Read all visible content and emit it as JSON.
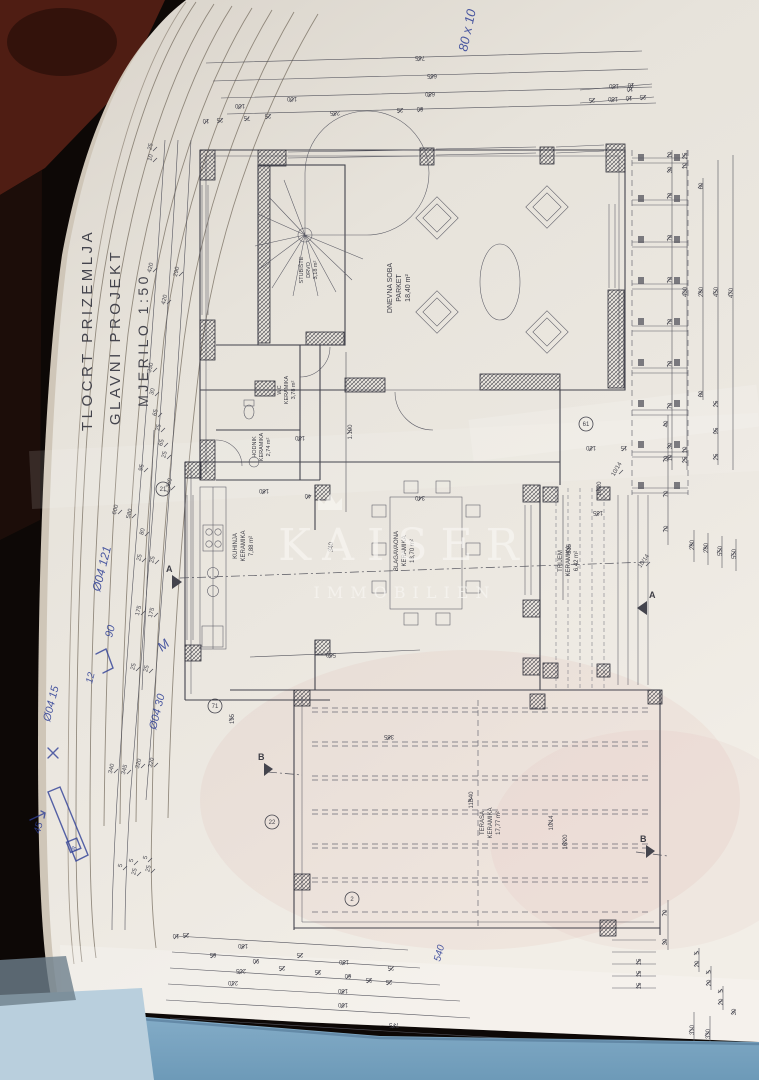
{
  "title_block": {
    "line1": "TLOCRT PRIZEMLJA",
    "line2": "GLAVNI PROJEKT",
    "line3": "MJERILO 1:50"
  },
  "watermark": {
    "name": "KAISER",
    "subtitle": "IMMOBILIEN",
    "icon": "crown"
  },
  "rooms": [
    {
      "name": "STUBIŠTE",
      "finish": "DRVO",
      "area": "3,18 m²"
    },
    {
      "name": "DNEVNA SOBA",
      "finish": "PARKET",
      "area": "18,40 m²"
    },
    {
      "name": "WC",
      "finish": "KERAMIKA",
      "area": "3,78 m²"
    },
    {
      "name": "HODNIK",
      "finish": "KERAMIKA",
      "area": "2,74 m²"
    },
    {
      "name": "KUHINJA",
      "finish": "KERAMIKA",
      "area": "7,88 m²"
    },
    {
      "name": "BLAGAVAONA",
      "finish": "KERAMIKA",
      "area": "18,70 m²"
    },
    {
      "name": "TRIJEM",
      "finish": "KERAMIKA",
      "area": "6,42 m²"
    },
    {
      "name": "TERASA",
      "finish": "KERAMIKA",
      "area": "17,77 m²"
    }
  ],
  "markers": {
    "section_a": "A",
    "section_b": "B",
    "circled": [
      {
        "t": "21",
        "x": 163,
        "y": 489
      },
      {
        "t": "71",
        "x": 215,
        "y": 706
      },
      {
        "t": "22",
        "x": 272,
        "y": 822
      },
      {
        "t": "61",
        "x": 586,
        "y": 424
      },
      {
        "t": "2",
        "x": 352,
        "y": 899
      }
    ]
  },
  "handwritten": {
    "top_right": "80 x 10",
    "n1": "Ø04 121",
    "n2": "90",
    "n3": "12",
    "n4": "Ø04 15",
    "n5": "Ø04 30",
    "n6": "M",
    "n7": "45",
    "n8": "8",
    "n9": "540"
  },
  "colors": {
    "paper": "#eae6df",
    "ink": "#43434d",
    "book_blue": "#7ba6c4",
    "pages_blue": "#b9cfdd",
    "handwriting_blue": "#2e3f96",
    "carpet_red": "#4f1d13"
  },
  "plan": {
    "dim_labels": [
      {
        "t": "765",
        "x": 420,
        "y": 56,
        "r": 180
      },
      {
        "t": "665",
        "x": 432,
        "y": 74,
        "r": 180
      },
      {
        "t": "100",
        "x": 292,
        "y": 97,
        "r": 180
      },
      {
        "t": "630",
        "x": 430,
        "y": 92,
        "r": 180
      },
      {
        "t": "10",
        "x": 630,
        "y": 87,
        "r": 180
      },
      {
        "t": "10",
        "x": 206,
        "y": 119,
        "r": 180
      },
      {
        "t": "25",
        "x": 220,
        "y": 118,
        "r": 180
      },
      {
        "t": "75",
        "x": 247,
        "y": 116,
        "r": 180
      },
      {
        "t": "25",
        "x": 268,
        "y": 114,
        "r": 180
      },
      {
        "t": "235",
        "x": 335,
        "y": 111,
        "r": 180
      },
      {
        "t": "25",
        "x": 400,
        "y": 108,
        "r": 180
      },
      {
        "t": "60",
        "x": 420,
        "y": 107,
        "r": 180
      },
      {
        "t": "100",
        "x": 240,
        "y": 104,
        "r": 180
      },
      {
        "t": "150",
        "x": 614,
        "y": 84,
        "r": 180
      },
      {
        "t": "10",
        "x": 631,
        "y": 83,
        "r": 180
      },
      {
        "t": "25",
        "x": 592,
        "y": 98,
        "r": 180
      },
      {
        "t": "150",
        "x": 613,
        "y": 97,
        "r": 180
      },
      {
        "t": "10",
        "x": 629,
        "y": 96,
        "r": 180
      },
      {
        "t": "25",
        "x": 643,
        "y": 95,
        "r": 180
      },
      {
        "t": "10",
        "x": 672,
        "y": 155,
        "r": -90
      },
      {
        "t": "30",
        "x": 672,
        "y": 170,
        "r": -90
      },
      {
        "t": "78",
        "x": 672,
        "y": 196,
        "r": -90
      },
      {
        "t": "78",
        "x": 672,
        "y": 238,
        "r": -90
      },
      {
        "t": "78",
        "x": 672,
        "y": 280,
        "r": -90
      },
      {
        "t": "78",
        "x": 672,
        "y": 322,
        "r": -90
      },
      {
        "t": "78",
        "x": 672,
        "y": 364,
        "r": -90
      },
      {
        "t": "78",
        "x": 672,
        "y": 406,
        "r": -90
      },
      {
        "t": "30",
        "x": 672,
        "y": 446,
        "r": -90
      },
      {
        "t": "10",
        "x": 672,
        "y": 458,
        "r": -90
      },
      {
        "t": "25",
        "x": 687,
        "y": 156,
        "r": -90
      },
      {
        "t": "10",
        "x": 687,
        "y": 166,
        "r": -90
      },
      {
        "t": "400",
        "x": 687,
        "y": 292,
        "r": -90
      },
      {
        "t": "10",
        "x": 687,
        "y": 450,
        "r": -90
      },
      {
        "t": "25",
        "x": 687,
        "y": 460,
        "r": -90
      },
      {
        "t": "60",
        "x": 703,
        "y": 186,
        "r": -90
      },
      {
        "t": "280",
        "x": 703,
        "y": 292,
        "r": -90
      },
      {
        "t": "60",
        "x": 703,
        "y": 394,
        "r": -90
      },
      {
        "t": "450",
        "x": 718,
        "y": 292,
        "r": -90
      },
      {
        "t": "25",
        "x": 718,
        "y": 404,
        "r": -90
      },
      {
        "t": "95",
        "x": 718,
        "y": 431,
        "r": -90
      },
      {
        "t": "25",
        "x": 718,
        "y": 457,
        "r": -90
      },
      {
        "t": "470",
        "x": 733,
        "y": 293,
        "r": -90
      },
      {
        "t": "40",
        "x": 668,
        "y": 424,
        "r": -90
      },
      {
        "t": "70",
        "x": 668,
        "y": 459,
        "r": -90
      },
      {
        "t": "70",
        "x": 668,
        "y": 494,
        "r": -90
      },
      {
        "t": "70",
        "x": 668,
        "y": 529,
        "r": -90
      },
      {
        "t": "280",
        "x": 694,
        "y": 545,
        "r": -90
      },
      {
        "t": "280",
        "x": 708,
        "y": 548,
        "r": -90
      },
      {
        "t": "550",
        "x": 722,
        "y": 551,
        "r": -90
      },
      {
        "t": "550",
        "x": 736,
        "y": 554,
        "r": -90
      },
      {
        "t": "70",
        "x": 667,
        "y": 913,
        "r": -90
      },
      {
        "t": "30",
        "x": 667,
        "y": 942,
        "r": -90
      },
      {
        "t": "5",
        "x": 699,
        "y": 953,
        "r": -90
      },
      {
        "t": "20",
        "x": 699,
        "y": 964,
        "r": -90
      },
      {
        "t": "5",
        "x": 711,
        "y": 972,
        "r": -90
      },
      {
        "t": "20",
        "x": 711,
        "y": 983,
        "r": -90
      },
      {
        "t": "5",
        "x": 723,
        "y": 991,
        "r": -90
      },
      {
        "t": "20",
        "x": 723,
        "y": 1002,
        "r": -90
      },
      {
        "t": "30",
        "x": 736,
        "y": 1012,
        "r": -90
      },
      {
        "t": "310",
        "x": 694,
        "y": 1030,
        "r": -90
      },
      {
        "t": "330",
        "x": 710,
        "y": 1034,
        "r": -90
      },
      {
        "t": "15",
        "x": 641,
        "y": 962,
        "r": -90,
        "s": 5
      },
      {
        "t": "15",
        "x": 641,
        "y": 974,
        "r": -90,
        "s": 5
      },
      {
        "t": "15",
        "x": 641,
        "y": 986,
        "r": -90,
        "s": 5
      },
      {
        "t": "25",
        "x": 152,
        "y": 147,
        "r": -75
      },
      {
        "t": "10",
        "x": 152,
        "y": 158,
        "r": -75
      },
      {
        "t": "420",
        "x": 152,
        "y": 268,
        "r": -75
      },
      {
        "t": "290",
        "x": 178,
        "y": 272,
        "r": -75
      },
      {
        "t": "420",
        "x": 166,
        "y": 300,
        "r": -75
      },
      {
        "t": "330",
        "x": 152,
        "y": 368,
        "r": -75
      },
      {
        "t": "30",
        "x": 154,
        "y": 392,
        "r": -75
      },
      {
        "t": "65",
        "x": 157,
        "y": 413,
        "r": -75
      },
      {
        "t": "25",
        "x": 160,
        "y": 428,
        "r": -75
      },
      {
        "t": "65",
        "x": 163,
        "y": 443,
        "r": -75
      },
      {
        "t": "25",
        "x": 166,
        "y": 455,
        "r": -75
      },
      {
        "t": "95",
        "x": 143,
        "y": 468,
        "r": -75
      },
      {
        "t": "1.360",
        "x": 170,
        "y": 486,
        "r": -75
      },
      {
        "t": "600",
        "x": 117,
        "y": 510,
        "r": -75
      },
      {
        "t": "580",
        "x": 131,
        "y": 514,
        "r": -75
      },
      {
        "t": "80",
        "x": 144,
        "y": 532,
        "r": -75
      },
      {
        "t": "25",
        "x": 141,
        "y": 558,
        "r": -75
      },
      {
        "t": "25",
        "x": 154,
        "y": 560,
        "r": -75
      },
      {
        "t": "175",
        "x": 140,
        "y": 611,
        "r": -75
      },
      {
        "t": "175",
        "x": 153,
        "y": 613,
        "r": -75
      },
      {
        "t": "25",
        "x": 135,
        "y": 667,
        "r": -75
      },
      {
        "t": "25",
        "x": 148,
        "y": 669,
        "r": -75
      },
      {
        "t": "340",
        "x": 113,
        "y": 769,
        "r": -75
      },
      {
        "t": "345",
        "x": 126,
        "y": 770,
        "r": -75
      },
      {
        "t": "320",
        "x": 140,
        "y": 764,
        "r": -75
      },
      {
        "t": "320",
        "x": 153,
        "y": 763,
        "r": -75
      },
      {
        "t": "5",
        "x": 122,
        "y": 866,
        "r": -75
      },
      {
        "t": "5",
        "x": 133,
        "y": 861,
        "r": -75
      },
      {
        "t": "25",
        "x": 136,
        "y": 872,
        "r": -75,
        "s": 5
      },
      {
        "t": "5",
        "x": 147,
        "y": 858,
        "r": -75
      },
      {
        "t": "25",
        "x": 150,
        "y": 869,
        "r": -75,
        "s": 5
      },
      {
        "t": "1.190",
        "x": 352,
        "y": 432,
        "r": -90
      },
      {
        "t": "130",
        "x": 300,
        "y": 436,
        "r": 180
      },
      {
        "t": "180",
        "x": 264,
        "y": 489,
        "r": 180
      },
      {
        "t": "340",
        "x": 420,
        "y": 496,
        "r": 180
      },
      {
        "t": "40",
        "x": 308,
        "y": 494,
        "r": 180
      },
      {
        "t": "340",
        "x": 333,
        "y": 547,
        "r": -90
      },
      {
        "t": "560",
        "x": 331,
        "y": 653,
        "r": 180
      },
      {
        "t": "515",
        "x": 571,
        "y": 549,
        "r": -90
      },
      {
        "t": "135",
        "x": 598,
        "y": 511,
        "r": 180
      },
      {
        "t": "120",
        "x": 591,
        "y": 446,
        "r": 180
      },
      {
        "t": "15",
        "x": 624,
        "y": 446,
        "r": 180
      },
      {
        "t": "195",
        "x": 234,
        "y": 719,
        "r": -90
      },
      {
        "t": "385",
        "x": 389,
        "y": 735,
        "r": 180
      },
      {
        "t": "10/14",
        "x": 645,
        "y": 562,
        "r": -55,
        "s": 5
      },
      {
        "t": "16/20",
        "x": 601,
        "y": 489,
        "r": -90,
        "s": 5
      },
      {
        "t": "10/14",
        "x": 618,
        "y": 470,
        "r": -60,
        "s": 5
      },
      {
        "t": "16/20",
        "x": 567,
        "y": 842,
        "r": -90,
        "s": 5
      },
      {
        "t": "10/14",
        "x": 553,
        "y": 823,
        "r": -90,
        "s": 5
      },
      {
        "t": "11B40",
        "x": 473,
        "y": 800,
        "r": -90,
        "s": 5
      },
      {
        "t": "25",
        "x": 186,
        "y": 933,
        "r": 180
      },
      {
        "t": "10",
        "x": 176,
        "y": 934,
        "r": 180
      },
      {
        "t": "180",
        "x": 243,
        "y": 944,
        "r": 180
      },
      {
        "t": "65",
        "x": 213,
        "y": 953,
        "r": 180
      },
      {
        "t": "90",
        "x": 256,
        "y": 959,
        "r": 180
      },
      {
        "t": "25",
        "x": 300,
        "y": 953,
        "r": 180
      },
      {
        "t": "130",
        "x": 344,
        "y": 960,
        "r": 180
      },
      {
        "t": "25",
        "x": 391,
        "y": 966,
        "r": 180
      },
      {
        "t": "205",
        "x": 241,
        "y": 969,
        "r": 180
      },
      {
        "t": "25",
        "x": 282,
        "y": 966,
        "r": 180
      },
      {
        "t": "35",
        "x": 318,
        "y": 970,
        "r": 180
      },
      {
        "t": "60",
        "x": 348,
        "y": 974,
        "r": 180
      },
      {
        "t": "35",
        "x": 369,
        "y": 978,
        "r": 180
      },
      {
        "t": "25",
        "x": 389,
        "y": 980,
        "r": 180
      },
      {
        "t": "210",
        "x": 233,
        "y": 981,
        "r": 180
      },
      {
        "t": "180",
        "x": 343,
        "y": 989,
        "r": 180
      },
      {
        "t": "190",
        "x": 343,
        "y": 1003,
        "r": 180
      },
      {
        "t": "775",
        "x": 394,
        "y": 1023,
        "r": 180
      }
    ]
  }
}
